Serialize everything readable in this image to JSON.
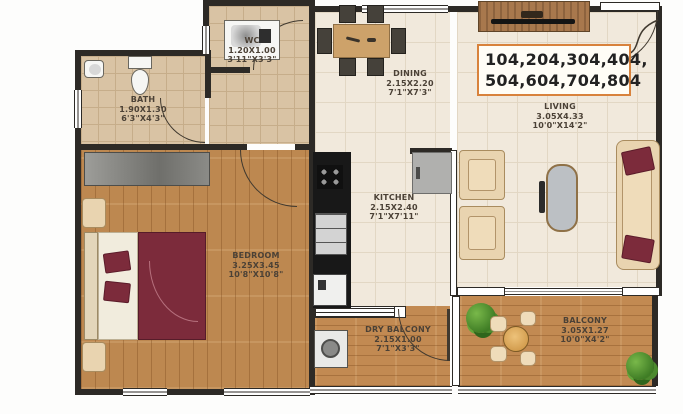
{
  "units_box": {
    "line1": "104,204,304,404,",
    "line2": "504,604,704,804"
  },
  "rooms": {
    "wc": {
      "name": "WC",
      "size_m": "1.20X1.00",
      "size_ft": "3'11\"X3'3\""
    },
    "bath": {
      "name": "BATH",
      "size_m": "1.90X1.30",
      "size_ft": "6'3\"X4'3\""
    },
    "dining": {
      "name": "DINING",
      "size_m": "2.15X2.20",
      "size_ft": "7'1\"X7'3\""
    },
    "living": {
      "name": "LIVING",
      "size_m": "3.05X4.33",
      "size_ft": "10'0\"X14'2\""
    },
    "kitchen": {
      "name": "KITCHEN",
      "size_m": "2.15X2.40",
      "size_ft": "7'1\"X7'11\""
    },
    "bedroom": {
      "name": "BEDROOM",
      "size_m": "3.25X3.45",
      "size_ft": "10'8\"X10'8\""
    },
    "dry_balcony": {
      "name": "DRY BALCONY",
      "size_m": "2.15X1.00",
      "size_ft": "7'1\"X3'3\""
    },
    "balcony": {
      "name": "BALCONY",
      "size_m": "3.05X1.27",
      "size_ft": "10'0\"X4'2\""
    }
  },
  "colors": {
    "wall": "#2d2a26",
    "accent_box_border": "#d8823c",
    "floor_cream": "#f1e9dc",
    "floor_tan": "#d9c3a4",
    "wood": "#bd8850",
    "sofa_beige": "#e9d4b0",
    "maroon": "#7c2b3b",
    "counter_black": "#181818",
    "plant_green": "#4c8a2e",
    "label_text": "#4b4136"
  }
}
